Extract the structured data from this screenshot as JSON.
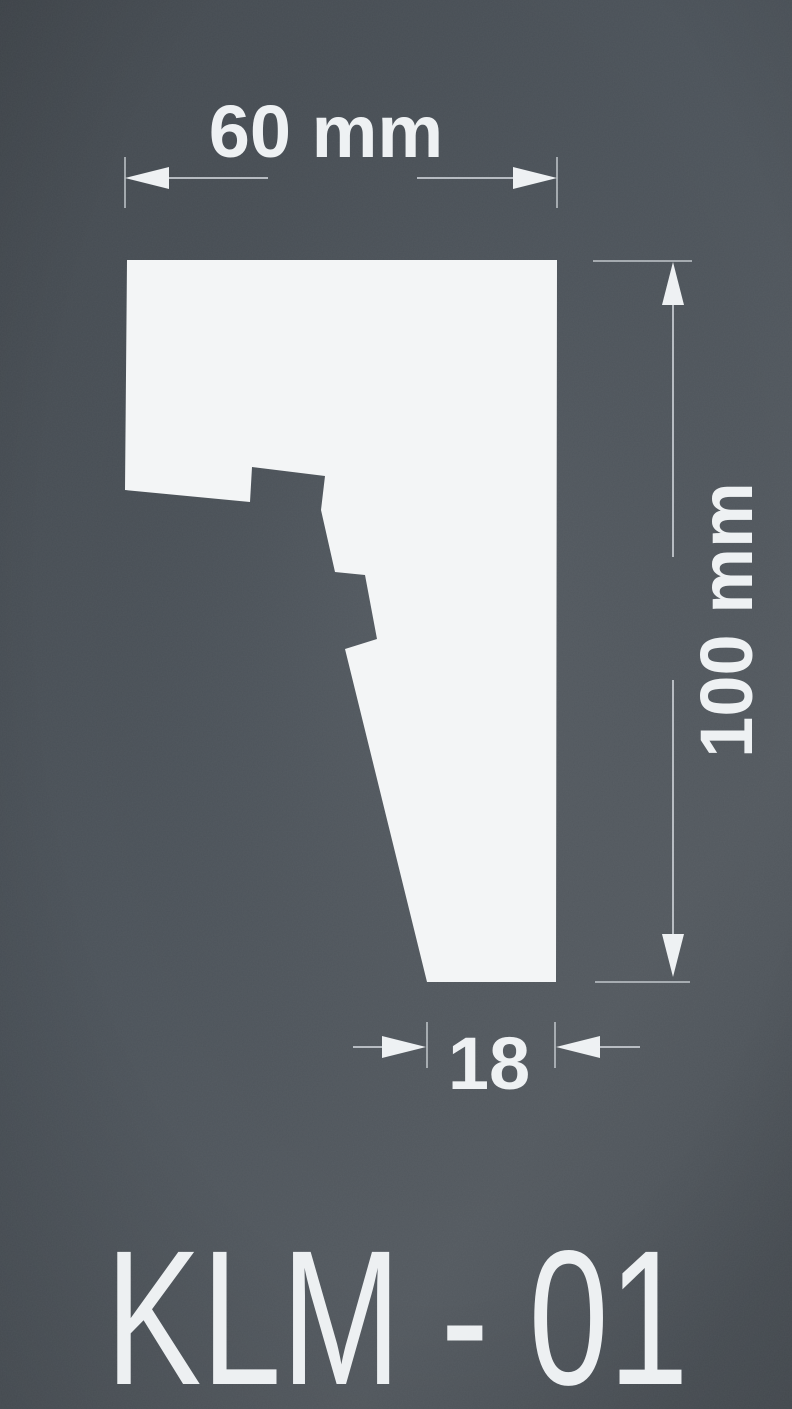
{
  "drawing": {
    "title": "KLM - 01",
    "dimensions": {
      "width_label": "60 mm",
      "height_label": "100 mm",
      "foot_width_label": "18"
    }
  },
  "colors": {
    "background_top": "#42484e",
    "background_mid": "#4b5259",
    "background_lower": "#53595f",
    "background_bottom": "#4a5056",
    "shape_fill": "#f3f5f6",
    "dimension_lines": "#c9ced3",
    "text": "#eef1f3"
  }
}
